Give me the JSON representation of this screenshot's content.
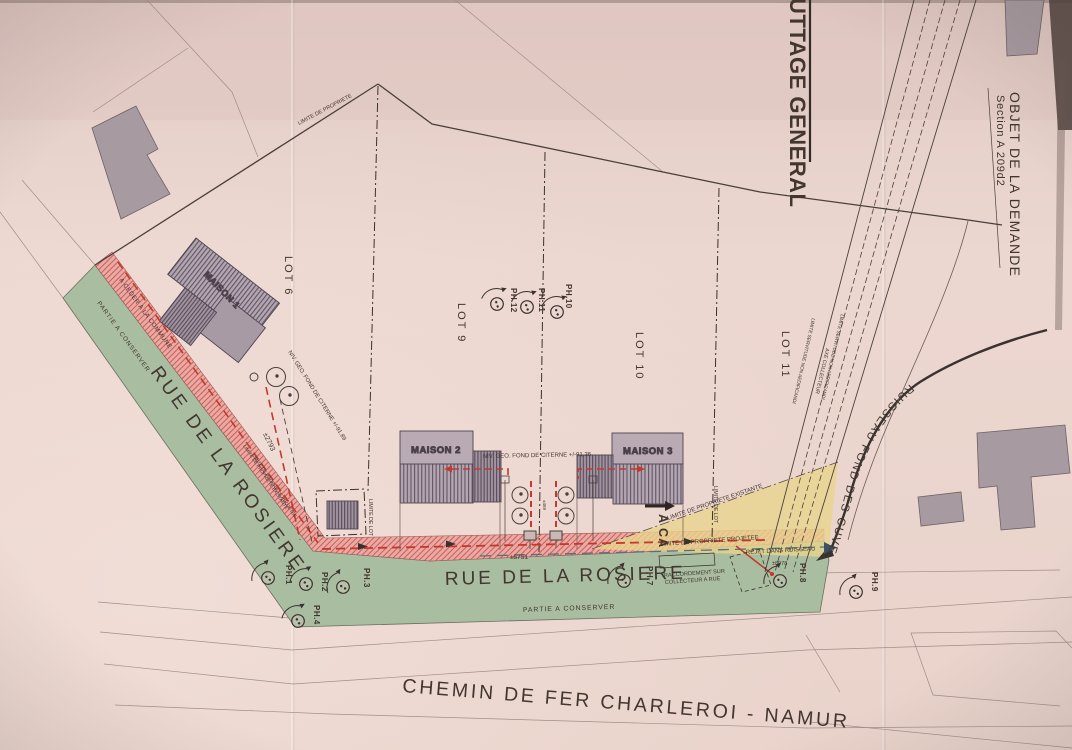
{
  "plan": {
    "title_partial": "UTTAGE GENERAL",
    "request_object": {
      "label": "OBJET DE LA DEMANDE",
      "section": "Section A 209d2"
    },
    "railway": "CHEMIN DE FER CHARLEROI - NAMUR",
    "stream": "RUISSEAU FOND DES CUVES",
    "streets": {
      "diagonal": "RUE DE LA ROSIERE",
      "horizontal": "RUE DE LA ROSIERE",
      "keep_note_diagonal": "PARTIE A CONSERVER",
      "keep_note_horizontal": "PARTIE A CONSERVER",
      "cession_note": "A CEDER A LA COMMUNE"
    },
    "lots": [
      {
        "label": "LOT 6"
      },
      {
        "label": "LOT 9"
      },
      {
        "label": "LOT 10"
      },
      {
        "label": "LOT 11"
      }
    ],
    "houses": [
      {
        "label": "MAISON 1"
      },
      {
        "label": "MAISON 2"
      },
      {
        "label": "MAISON 3"
      }
    ],
    "manholes": [
      {
        "label": "PH.1"
      },
      {
        "label": "PH.2"
      },
      {
        "label": "PH.3"
      },
      {
        "label": "PH.4"
      },
      {
        "label": "PH.7"
      },
      {
        "label": "PH.8"
      },
      {
        "label": "PH.9"
      },
      {
        "label": "PH.10"
      },
      {
        "label": "PH.11"
      },
      {
        "label": "PH.12"
      }
    ],
    "levels": {
      "citerne_m1": "NIV. GEO. FOND DE CITERNE +/-91.89",
      "citerne_m2m3": "NIV. GEO. FOND DE CITERNE +/-91.36"
    },
    "limits": {
      "property": "LIMITE DE PROPRIETE",
      "property_existing": "LIMITE DE PROPRIETE EXISTANTE",
      "property_projected": "LIMITE DE PROPRIETE PROJETEE",
      "lot": "LIMITE DE LOT",
      "servitude": "LIMITE SERVITUDE NON AEDIFICANDI",
      "collector_axis": "AXE COLLECTEUR"
    },
    "sewer": {
      "raccordement_l1": "RACCORDEMENT SUR",
      "raccordement_l2": "COLLECTEUR A RUE",
      "rejet": "REJET DANS RUISSEAU",
      "section_marker": "A CA"
    },
    "dimensions": {
      "street_diag": "±2793",
      "street_main": "±5751",
      "outfall": "±8978",
      "lot_split": "±469"
    },
    "colors": {
      "paper": "#e9d2cb",
      "street_green": "#a9bda1",
      "cession_pink": "#eca9a3",
      "hatch_red": "#c4605c",
      "sewer_red": "#c23a2e",
      "rejet_blue": "#3b5166",
      "yellow_zone": "#e9d58d",
      "building_gray": "#a79aa0",
      "line_dark": "#463c38"
    }
  }
}
